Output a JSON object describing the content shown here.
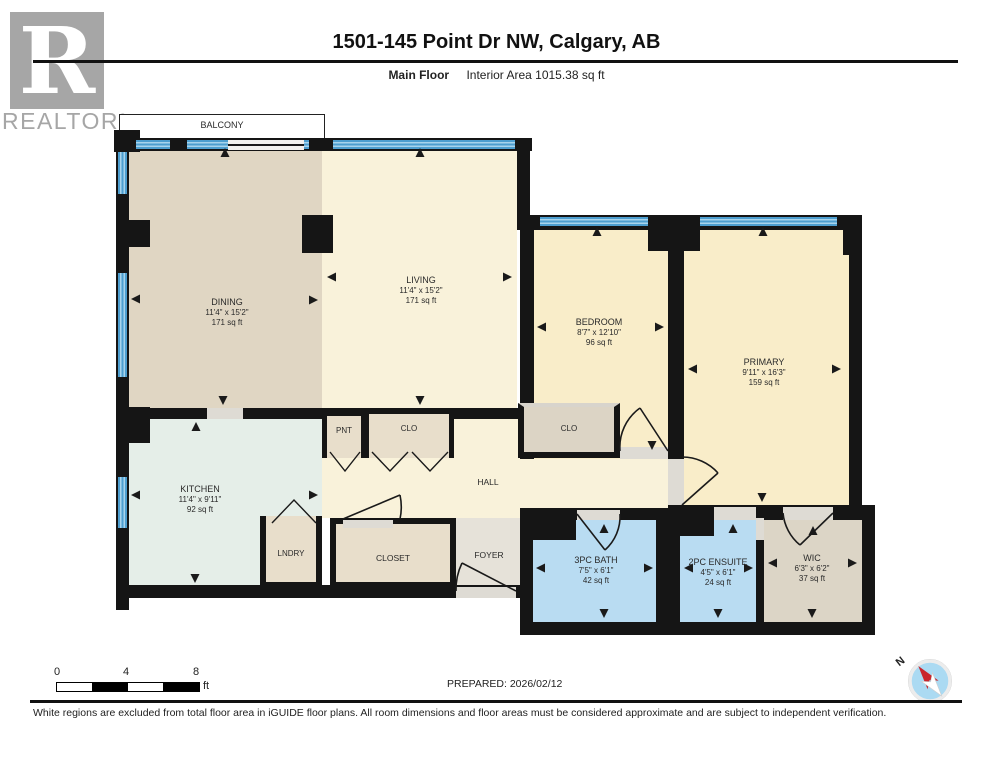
{
  "header": {
    "logo_letter": "R",
    "logo_text": "REALTOR",
    "logo_reg": "®",
    "title": "1501-145 Point Dr NW, Calgary, AB",
    "floor_label": "Main Floor",
    "interior_area_label": "Interior Area 1015.38 sq ft"
  },
  "rooms": {
    "balcony": {
      "name": "BALCONY"
    },
    "dining": {
      "name": "DINING",
      "dims": "11'4\" x 15'2\"",
      "area": "171 sq ft"
    },
    "living": {
      "name": "LIVING",
      "dims": "11'4\" x 15'2\"",
      "area": "171 sq ft"
    },
    "bedroom": {
      "name": "BEDROOM",
      "dims": "8'7\" x 12'10\"",
      "area": "96 sq ft"
    },
    "primary": {
      "name": "PRIMARY",
      "dims": "9'11\" x 16'3\"",
      "area": "159 sq ft"
    },
    "kitchen": {
      "name": "KITCHEN",
      "dims": "11'4\" x 9'11\"",
      "area": "92 sq ft"
    },
    "pantry": {
      "name": "PNT"
    },
    "hall_closet": {
      "name": "CLO"
    },
    "bedroom_closet": {
      "name": "CLO"
    },
    "hall": {
      "name": "HALL"
    },
    "laundry": {
      "name": "LNDRY"
    },
    "closet": {
      "name": "CLOSET"
    },
    "foyer": {
      "name": "FOYER"
    },
    "bath": {
      "name": "3PC BATH",
      "dims": "7'5\" x 6'1\"",
      "area": "42 sq ft"
    },
    "ensuite": {
      "name": "2PC ENSUITE",
      "dims": "4'5\" x 6'1\"",
      "area": "24 sq ft"
    },
    "wic": {
      "name": "WIC",
      "dims": "6'3\" x 6'2\"",
      "area": "37 sq ft"
    }
  },
  "scale_bar": {
    "ticks": [
      "0",
      "4",
      "8"
    ],
    "unit": "ft"
  },
  "footer": {
    "prepared": "PREPARED: 2026/02/12",
    "compass_north_label": "N",
    "disclaimer": "White regions are excluded from total floor area in iGUIDE floor plans. All room dimensions and floor areas must be considered approximate and are subject to independent verification."
  },
  "colors": {
    "wall": "#151515",
    "window_blue": "#4d9ecf",
    "window_stripe": "#a8d4ec",
    "dining": "#e0d6c3",
    "living_hall": "#f9f2da",
    "bedrooms": "#f9edc9",
    "kitchen": "#e5eee8",
    "closets": "#e8decb",
    "bedroom_closet": "#dcd4c5",
    "foyer": "#e6e2d9",
    "bath_blue": "#b9dcf2",
    "wic": "#dcd5c6",
    "logo_grey": "#a6a6a6",
    "compass_blue": "#abdaf2",
    "compass_red": "#c9252c"
  }
}
